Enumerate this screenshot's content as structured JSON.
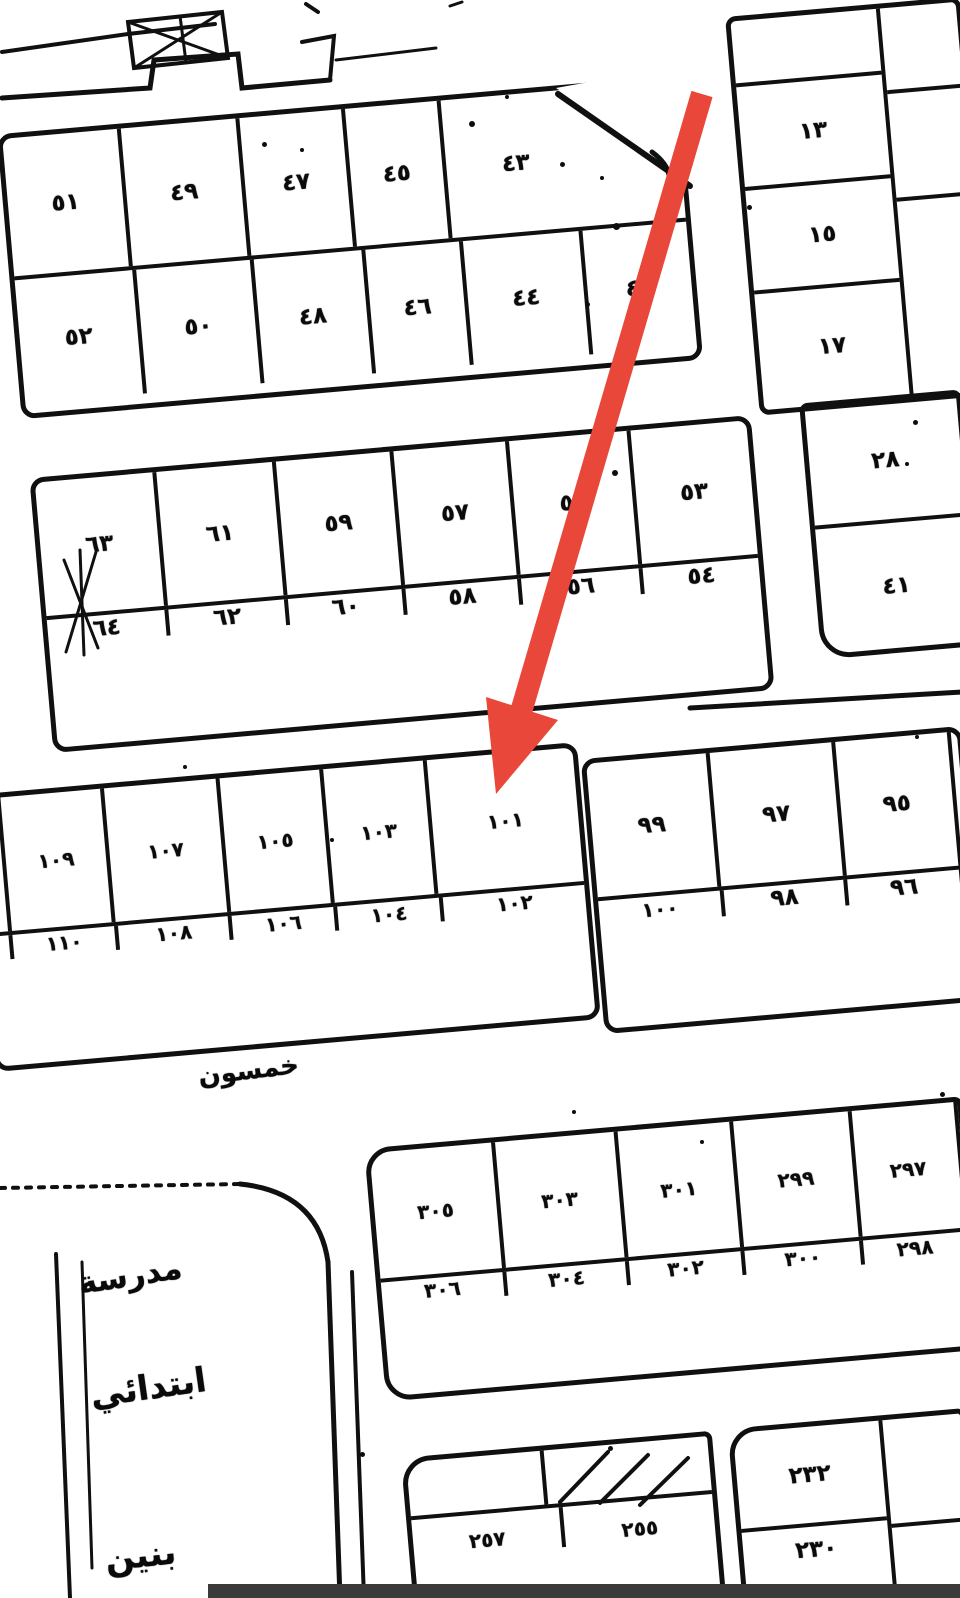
{
  "page": {
    "background": "#ffffff",
    "ink": "#101010",
    "bottom_bar_color": "#3a3a3a"
  },
  "arrow": {
    "color": "#e8473a",
    "target_plot": "١٠١"
  },
  "blocks": {
    "band1": {
      "row1": [
        "٥١",
        "٤٩",
        "٤٧",
        "٤٥",
        "٤٣"
      ],
      "row2": [
        "٥٢",
        "٥٠",
        "٤٨",
        "٤٦",
        "٤٤",
        "٤٢"
      ]
    },
    "band2": {
      "row1": [
        "٦٣",
        "٦١",
        "٥٩",
        "٥٧",
        "٥٥",
        "٥٣"
      ],
      "row2": [
        "٦٤",
        "٦٢",
        "٦٠",
        "٥٨",
        "٥٦",
        "٥٤"
      ]
    },
    "east_column": {
      "cells": [
        "١٣",
        "١٥",
        "١٧"
      ]
    },
    "east_block2": {
      "cells": [
        "٢٨",
        "٤١"
      ]
    },
    "band3_west": {
      "row1": [
        "١٠٩",
        "١٠٧",
        "١٠٥",
        "١٠٣",
        "١٠١"
      ],
      "row2": [
        "١١٠",
        "١٠٨",
        "١٠٦",
        "١٠٤",
        "١٠٢"
      ]
    },
    "band3_east": {
      "row1": [
        "٩٩",
        "٩٧",
        "٩٥"
      ],
      "row2": [
        "١٠٠",
        "٩٨",
        "٩٦"
      ]
    },
    "band4": {
      "row1": [
        "٣٠٥",
        "٣٠٣",
        "٣٠١",
        "٢٩٩",
        "٢٩٧"
      ],
      "row2": [
        "٣٠٦",
        "٣٠٤",
        "٣٠٢",
        "٣٠٠",
        "٢٩٨"
      ]
    },
    "south_center": {
      "cells": [
        "٢٥٧",
        "٢٥٥"
      ]
    },
    "south_east": {
      "cells": [
        "٢٣٢",
        "٢٣٠"
      ]
    }
  },
  "labels": {
    "street": "خمسون",
    "school_line1": "مدرسة",
    "school_line2": "ابتدائي",
    "school_line3": "بنين"
  }
}
